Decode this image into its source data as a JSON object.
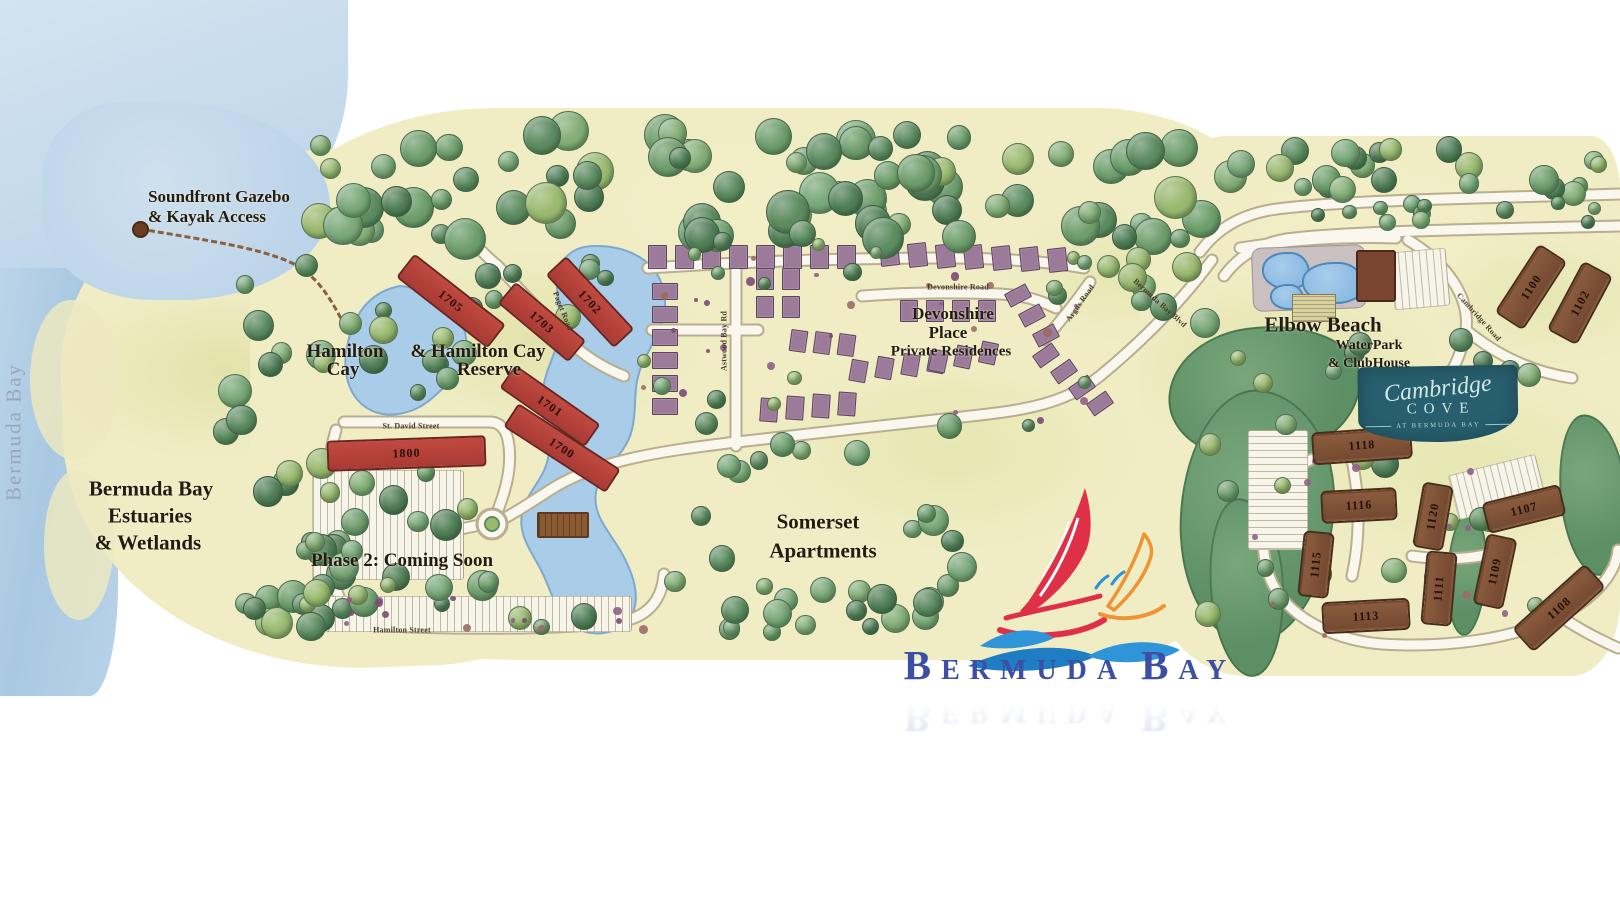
{
  "map": {
    "watermark": "Bermuda Bay",
    "colors": {
      "water": "#b7d2e8",
      "land": "#f0edc5",
      "lake": "#a9cde8",
      "road": "#faf8ee",
      "preserve": "#639268",
      "building_red": "#b23f38",
      "building_brown": "#7d5138",
      "townhouse": "#9b7b99",
      "logo_blue": "#3c4fa4",
      "sail_red": "#e03048",
      "sail_orange": "#ef9434",
      "wave_blue": "#2f94d8",
      "cambridge_teal": "#275f6e"
    },
    "area_labels": [
      {
        "name": "label-soundfront-line1",
        "text": "Soundfront Gazebo",
        "x": 219,
        "y": 197,
        "size": 17
      },
      {
        "name": "label-soundfront-line2",
        "text": "& Kayak Access",
        "x": 207,
        "y": 217,
        "size": 17
      },
      {
        "name": "label-estuaries-line1",
        "text": "Bermuda Bay",
        "x": 151,
        "y": 489,
        "size": 21
      },
      {
        "name": "label-estuaries-line2",
        "text": "Estuaries",
        "x": 150,
        "y": 516,
        "size": 21
      },
      {
        "name": "label-estuaries-line3",
        "text": "& Wetlands",
        "x": 148,
        "y": 543,
        "size": 21
      },
      {
        "name": "label-hamilton-cay-line1",
        "text": "Hamilton",
        "x": 345,
        "y": 352,
        "size": 19
      },
      {
        "name": "label-hamilton-cay-line2",
        "text": "Cay",
        "x": 343,
        "y": 370,
        "size": 19
      },
      {
        "name": "label-hamilton-reserve-line1",
        "text": "& Hamilton Cay",
        "x": 478,
        "y": 352,
        "size": 19
      },
      {
        "name": "label-hamilton-reserve-line2",
        "text": "Reserve",
        "x": 489,
        "y": 370,
        "size": 19
      },
      {
        "name": "label-phase2-coming-soon",
        "text": "Phase 2: Coming Soon",
        "x": 402,
        "y": 561,
        "size": 19
      },
      {
        "name": "label-somerset-line1",
        "text": "Somerset",
        "x": 818,
        "y": 522,
        "size": 21
      },
      {
        "name": "label-somerset-line2",
        "text": "Apartments",
        "x": 823,
        "y": 551,
        "size": 21
      },
      {
        "name": "label-devonshire-line1",
        "text": "Devonshire",
        "x": 953,
        "y": 314,
        "size": 17
      },
      {
        "name": "label-devonshire-line2",
        "text": "Place",
        "x": 948,
        "y": 333,
        "size": 17
      },
      {
        "name": "label-devonshire-line3",
        "text": "Private Residences",
        "x": 951,
        "y": 352,
        "size": 15
      },
      {
        "name": "label-elbow-beach-line1",
        "text": "Elbow Beach",
        "x": 1323,
        "y": 325,
        "size": 21
      },
      {
        "name": "label-elbow-beach-line2",
        "text": "WaterPark",
        "x": 1369,
        "y": 346,
        "size": 14
      },
      {
        "name": "label-elbow-beach-line3",
        "text": "& ClubHouse",
        "x": 1369,
        "y": 364,
        "size": 14
      }
    ],
    "road_labels": [
      {
        "name": "road-label-st-david-street",
        "text": "St. David Street",
        "x": 411,
        "y": 426,
        "rotate": 0
      },
      {
        "name": "road-label-hamilton-street",
        "text": "Hamilton Street",
        "x": 402,
        "y": 630,
        "rotate": 0
      },
      {
        "name": "road-label-paget-road",
        "text": "Paget Road",
        "x": 563,
        "y": 311,
        "rotate": 68
      },
      {
        "name": "road-label-devonshire-road",
        "text": "Devonshire Road",
        "x": 958,
        "y": 287,
        "rotate": 0
      },
      {
        "name": "road-label-astwood-bay-rd",
        "text": "Astwood Bay Rd",
        "x": 724,
        "y": 341,
        "rotate": -90
      },
      {
        "name": "road-label-argus-road",
        "text": "Argus Road",
        "x": 1080,
        "y": 303,
        "rotate": -55
      },
      {
        "name": "road-label-bermuda-bay-blvd",
        "text": "Bermuda Bay Blvd",
        "x": 1160,
        "y": 303,
        "rotate": 42
      },
      {
        "name": "road-label-cambridge-road",
        "text": "Cambridge Road",
        "x": 1479,
        "y": 317,
        "rotate": 48
      }
    ],
    "buildings": {
      "red": [
        {
          "num": "1705",
          "x": 449,
          "y": 299,
          "len": 112,
          "wid": 26,
          "angle": 38
        },
        {
          "num": "1703",
          "x": 540,
          "y": 320,
          "len": 88,
          "wid": 24,
          "angle": 40
        },
        {
          "num": "1702",
          "x": 588,
          "y": 300,
          "len": 96,
          "wid": 24,
          "angle": 47
        },
        {
          "num": "1701",
          "x": 548,
          "y": 404,
          "len": 100,
          "wid": 24,
          "angle": 35
        },
        {
          "num": "1700",
          "x": 560,
          "y": 446,
          "len": 118,
          "wid": 24,
          "angle": 33
        },
        {
          "num": "1800",
          "x": 404,
          "y": 451,
          "len": 155,
          "wid": 27,
          "angle": -2
        }
      ],
      "brown": [
        {
          "num": "1100",
          "x": 1529,
          "y": 285,
          "len": 74,
          "wid": 26,
          "angle": -57
        },
        {
          "num": "1102",
          "x": 1578,
          "y": 301,
          "len": 70,
          "wid": 26,
          "angle": -62
        },
        {
          "num": "1118",
          "x": 1360,
          "y": 443,
          "len": 92,
          "wid": 25,
          "angle": -4
        },
        {
          "num": "1116",
          "x": 1357,
          "y": 503,
          "len": 68,
          "wid": 25,
          "angle": -3
        },
        {
          "num": "1120",
          "x": 1431,
          "y": 514,
          "len": 58,
          "wid": 23,
          "angle": -80
        },
        {
          "num": "1107",
          "x": 1522,
          "y": 507,
          "len": 72,
          "wid": 24,
          "angle": -14
        },
        {
          "num": "1115",
          "x": 1314,
          "y": 562,
          "len": 58,
          "wid": 23,
          "angle": -84
        },
        {
          "num": "1111",
          "x": 1437,
          "y": 586,
          "len": 66,
          "wid": 23,
          "angle": -85
        },
        {
          "num": "1109",
          "x": 1493,
          "y": 569,
          "len": 64,
          "wid": 23,
          "angle": -78
        },
        {
          "num": "1113",
          "x": 1364,
          "y": 614,
          "len": 80,
          "wid": 24,
          "angle": -3
        },
        {
          "num": "1108",
          "x": 1557,
          "y": 606,
          "len": 90,
          "wid": 24,
          "angle": -42
        }
      ]
    },
    "cambridge_logo": {
      "line1": "Cambridge",
      "line2": "COVE",
      "line3": "AT BERMUDA BAY"
    },
    "logo": {
      "seg1": "B",
      "seg2": "ERMUDA",
      "seg3": "B",
      "seg4": "AY"
    }
  }
}
